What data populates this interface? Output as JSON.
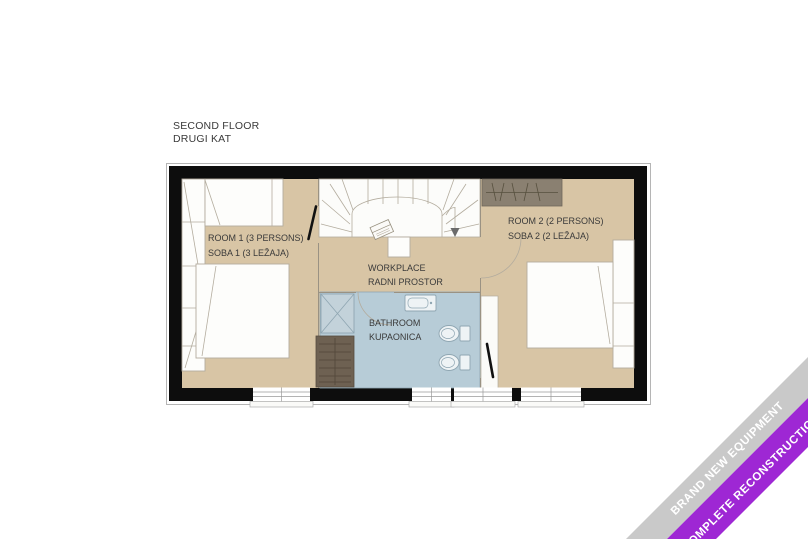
{
  "title": {
    "line1": "SECOND FLOOR",
    "line2": "DRUGI KAT"
  },
  "plan": {
    "room1": {
      "name": "ROOM 1 (3 PERSONS)",
      "name_hr": "SOBA 1 (3 LEŽAJA)"
    },
    "room2": {
      "name": "ROOM 2 (2 PERSONS)",
      "name_hr": "SOBA 2 (2 LEŽAJA)"
    },
    "workplace": {
      "name": "WORKPLACE",
      "name_hr": "RADNI PROSTOR"
    },
    "bathroom": {
      "name": "BATHROOM",
      "name_hr": "KUPAONICA"
    }
  },
  "ribbon": {
    "line1": "BRAND NEW EQUIPMENT",
    "line2": "COMPLETE RECONSTRUCTION"
  },
  "colors": {
    "wall": "#0d0d0d",
    "floor": "#d8c5a5",
    "bathroom_floor": "#b7ccd7",
    "wardrobe": "#8a8071",
    "bench": "#6e6152",
    "ribbon_gray": "#c9c9c9",
    "ribbon_purple": "#9e27d4"
  }
}
